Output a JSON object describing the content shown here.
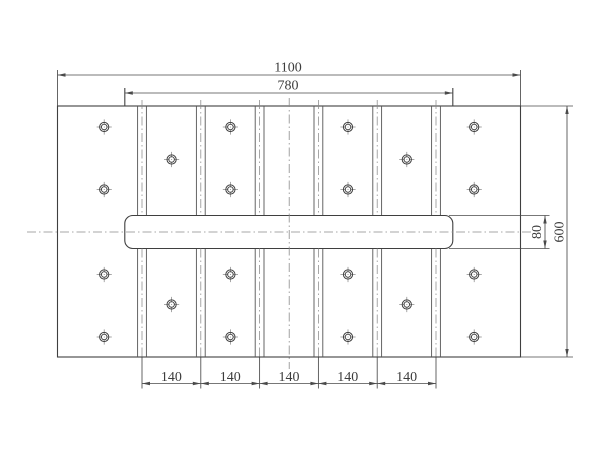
{
  "drawing": {
    "title": "plate-technical-drawing",
    "colors": {
      "background": "#ffffff",
      "outline": "#3f3f3f",
      "thin_line": "#555555",
      "centerline": "#8a8a8a",
      "dim_line": "#4a4a4a",
      "text": "#3d3d3d"
    },
    "dimensions": {
      "overall_width": {
        "label": "1100",
        "line_y": 75,
        "x1": 57.5,
        "x2": 520.5,
        "ext_top": 70,
        "text_x": 288,
        "text_y": 71.5
      },
      "inner_width": {
        "label": "780",
        "line_y": 93,
        "x1": 124.8,
        "x2": 452.8,
        "ext_top": 88,
        "text_x": 288,
        "text_y": 89.5
      },
      "overall_height": {
        "label": "600",
        "line_x": 567,
        "y1": 106,
        "y2": 357,
        "ext_x1": 521,
        "ext_x2": 573,
        "text_x": 559.5,
        "text_y": 232
      },
      "bar_height": {
        "label": "80",
        "line_x": 545,
        "y1": 215.5,
        "y2": 248.5,
        "ext_x1": 449,
        "ext_x2": 549.5,
        "text_x": 537,
        "text_y": 232
      },
      "pitch": {
        "label": "140",
        "count": 5,
        "line_y": 383.5,
        "ticks": [
          142,
          200.8,
          259.6,
          318.4,
          377.2,
          436
        ],
        "ext_y1": 357.5,
        "ext_y2": 388.5,
        "text_y": 381,
        "text_centers_x": [
          171.4,
          230.2,
          289.0,
          347.8,
          406.6
        ]
      }
    },
    "geometry": {
      "plate": {
        "x": 57.5,
        "y": 106,
        "w": 463,
        "h": 251
      },
      "bar": {
        "x": 124.8,
        "y": 215.5,
        "w": 328,
        "h": 33,
        "r": 8
      },
      "rails": {
        "centers_x": [
          142,
          200.8,
          259.6,
          318.4,
          377.2,
          436
        ],
        "half_width": 4.4,
        "upper_y": [
          106,
          215.5
        ],
        "lower_y": [
          248.5,
          357
        ],
        "centerline_y1": 100,
        "centerline_y2": 357
      },
      "platform_edges": {
        "xs": [
          124.8,
          452.8
        ],
        "y1": 88,
        "y2": 215.5
      },
      "center_mark": {
        "x": 289.2,
        "y": 232,
        "h_x1": 27,
        "h_x2": 533,
        "v_y1": 98,
        "v_y2": 369
      },
      "hole_style": {
        "r_outer": 4.6,
        "r_inner": 2.8,
        "cross_half": 7.6
      },
      "holes": [
        {
          "x": 104.2,
          "y": 127
        },
        {
          "x": 104.2,
          "y": 189.5
        },
        {
          "x": 104.2,
          "y": 274.5
        },
        {
          "x": 104.2,
          "y": 337
        },
        {
          "x": 230.4,
          "y": 127
        },
        {
          "x": 230.4,
          "y": 189.5
        },
        {
          "x": 230.4,
          "y": 274.5
        },
        {
          "x": 230.4,
          "y": 337
        },
        {
          "x": 348.0,
          "y": 127
        },
        {
          "x": 348.0,
          "y": 189.5
        },
        {
          "x": 348.0,
          "y": 274.5
        },
        {
          "x": 348.0,
          "y": 337
        },
        {
          "x": 474.2,
          "y": 127
        },
        {
          "x": 474.2,
          "y": 189.5
        },
        {
          "x": 474.2,
          "y": 274.5
        },
        {
          "x": 474.2,
          "y": 337
        },
        {
          "x": 171.6,
          "y": 159.5
        },
        {
          "x": 171.6,
          "y": 304.5
        },
        {
          "x": 406.8,
          "y": 159.5
        },
        {
          "x": 406.8,
          "y": 304.5
        }
      ]
    }
  }
}
